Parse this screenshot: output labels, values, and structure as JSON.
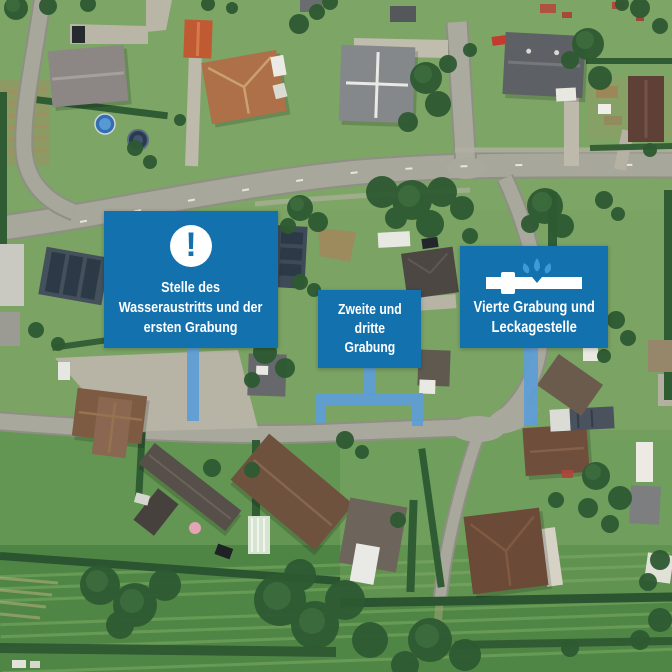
{
  "map": {
    "kind": "aerial-satellite-view",
    "description": "Aerial photo of a residential neighbourhood with houses, gardens, streets and fields"
  },
  "callouts": [
    {
      "icon": "exclamation-circle-icon",
      "icon_glyph": "!",
      "lines": [
        "Stelle des",
        "Wasseraustritts und der",
        "ersten Grabung"
      ]
    },
    {
      "icon": null,
      "lines": [
        "Zweite und",
        "dritte",
        "Grabung"
      ]
    },
    {
      "icon": "leaking-pipe-icon",
      "lines": [
        "Vierte Grabung und",
        "Leckagestelle"
      ]
    }
  ],
  "colors": {
    "callout_blue": "#1371ad",
    "connector_blue": "#5d9dd5",
    "droplet_blue": "#3f9bd4",
    "text": "#ffffff"
  }
}
